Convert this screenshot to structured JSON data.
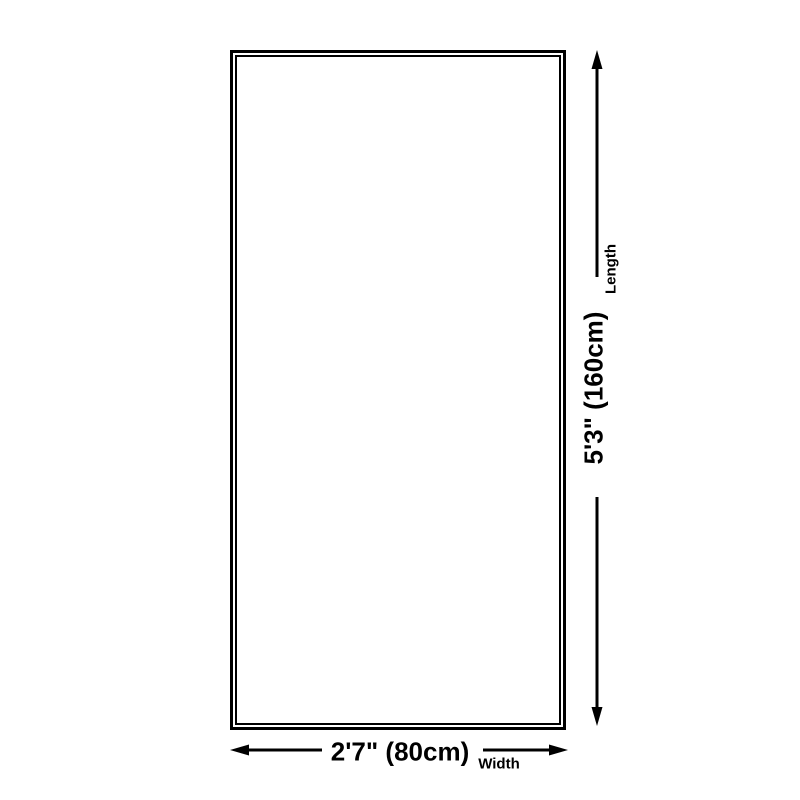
{
  "page": {
    "background": "#ffffff"
  },
  "colors": {
    "line": "#000000",
    "text": "#000000"
  },
  "diagram": {
    "type": "product-size-diagram",
    "shape": "rectangle"
  },
  "dimensions": {
    "length": {
      "value": "5'3\" (160cm)",
      "label": "Length"
    },
    "width": {
      "value": "2'7\" (80cm)",
      "label": "Width"
    }
  }
}
